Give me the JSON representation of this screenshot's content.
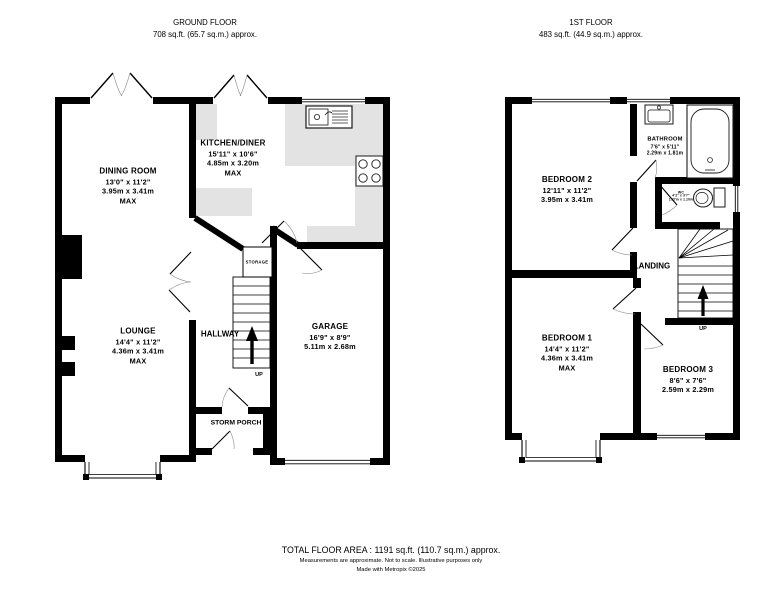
{
  "headers": {
    "ground": {
      "title": "GROUND FLOOR",
      "area": "708 sq.ft. (65.7 sq.m.) approx."
    },
    "first": {
      "title": "1ST FLOOR",
      "area": "483 sq.ft. (44.9 sq.m.) approx."
    }
  },
  "ground_floor": {
    "dining_room": {
      "name": "DINING ROOM",
      "imperial": "13'0\" x 11'2\"",
      "metric": "3.95m x 3.41m",
      "qualifier": "MAX"
    },
    "kitchen_diner": {
      "name": "KITCHEN/DINER",
      "imperial": "15'11\" x 10'6\"",
      "metric": "4.85m x 3.20m",
      "qualifier": "MAX"
    },
    "lounge": {
      "name": "LOUNGE",
      "imperial": "14'4\" x 11'2\"",
      "metric": "4.36m x 3.41m",
      "qualifier": "MAX"
    },
    "garage": {
      "name": "GARAGE",
      "imperial": "16'9\" x 8'9\"",
      "metric": "5.11m x 2.68m"
    },
    "hallway": {
      "name": "HALLWAY"
    },
    "storage": {
      "name": "STORAGE"
    },
    "storm_porch": {
      "name": "STORM PORCH"
    },
    "stairs_label": "UP"
  },
  "first_floor": {
    "bedroom_2": {
      "name": "BEDROOM 2",
      "imperial": "12'11\" x 11'2\"",
      "metric": "3.95m x 3.41m"
    },
    "bathroom": {
      "name": "BATHROOM",
      "imperial": "7'6\" x 5'11\"",
      "metric": "2.29m x 1.81m"
    },
    "wc": {
      "name": "WC",
      "imperial": "4'2\" x 3'7\"",
      "metric": "1.27m x 1.10m"
    },
    "landing": {
      "name": "LANDING"
    },
    "bedroom_1": {
      "name": "BEDROOM 1",
      "imperial": "14'4\" x 11'2\"",
      "metric": "4.36m x 3.41m",
      "qualifier": "MAX"
    },
    "bedroom_3": {
      "name": "BEDROOM 3",
      "imperial": "8'6\" x 7'6\"",
      "metric": "2.59m x 2.29m"
    },
    "stairs_label": "UP"
  },
  "footer": {
    "total_area": "TOTAL FLOOR AREA : 1191 sq.ft. (110.7 sq.m.) approx.",
    "disclaimer": "Measurements are approximate.  Not to scale.  Illustrative purposes only",
    "credit": "Made with Metropix ©2025"
  },
  "colors": {
    "wall": "#000000",
    "counter": "#e3e3e3",
    "background": "#ffffff"
  }
}
